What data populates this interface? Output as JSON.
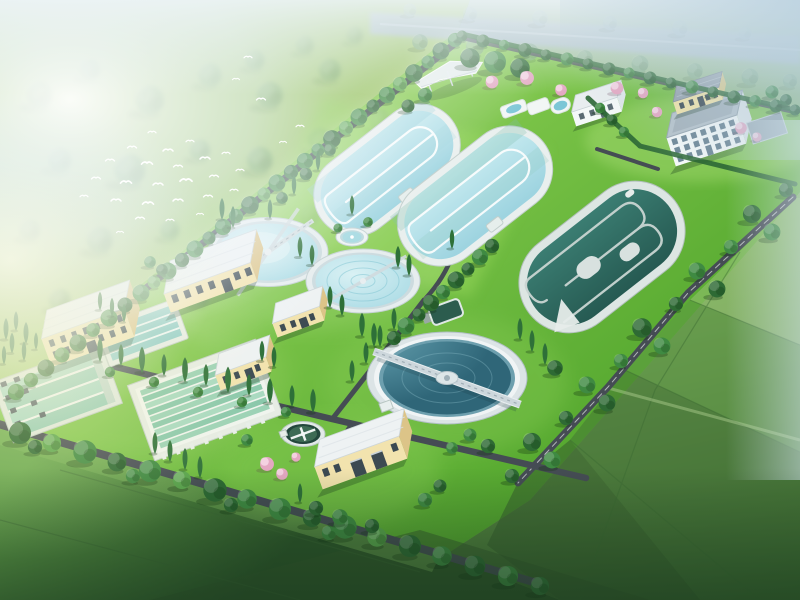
{
  "scene": {
    "subject": "aerial-3d-rendering-of-wastewater-treatment-plant",
    "environment": [
      "morning-mist",
      "white-bird-flock",
      "tree-lined-boundary-roads",
      "patchwork-farm-fields",
      "riverside-road-top"
    ],
    "bird_count": 30,
    "objects": [
      "oxidation-ditch-1",
      "oxidation-ditch-2",
      "dark-serpentine-basin",
      "clarifier-1",
      "clarifier-2",
      "large-secondary-clarifier",
      "fountain-pond",
      "sludge-thickener",
      "small-dark-pond",
      "sedimentation-basin-row-a",
      "sedimentation-basin-large",
      "aerated-grit-basin",
      "yellow-process-building",
      "long-cream-building",
      "small-building-a",
      "small-building-b",
      "workshop-building",
      "office-building",
      "yellow-gatehouse",
      "white-utility-building",
      "white-pavilion",
      "landscape-pool",
      "pink-blossom-trees",
      "cypress-rows"
    ]
  },
  "palette": {
    "base_green": "#74ad4c",
    "meadow": "#a6cb74",
    "road": "#454c54",
    "wall_cream": "#f2e3ae",
    "wall_cream_shade": "#dcc488",
    "wall_white": "#f4f8f8",
    "wall_white_shade": "#dfe6e9",
    "roof_light": "#eef2f3",
    "roof_grey": "#b6c2ca",
    "window_dark": "#3c4a52",
    "window_office": "#6b8494",
    "pond_dark": "#2c5c4e",
    "pond_green": "#3d6b54",
    "tree_mid": "#3f8a42",
    "tree_dark": "#2e6a34",
    "tree_light": "#5aa64d",
    "cypress": "#2e7038",
    "pink_tree": "#e4a8c2",
    "bird_white": "#ffffff",
    "water_light": "#b2e0e9",
    "water_dark": "#2f6f66",
    "water_deep": "#3c7486"
  }
}
